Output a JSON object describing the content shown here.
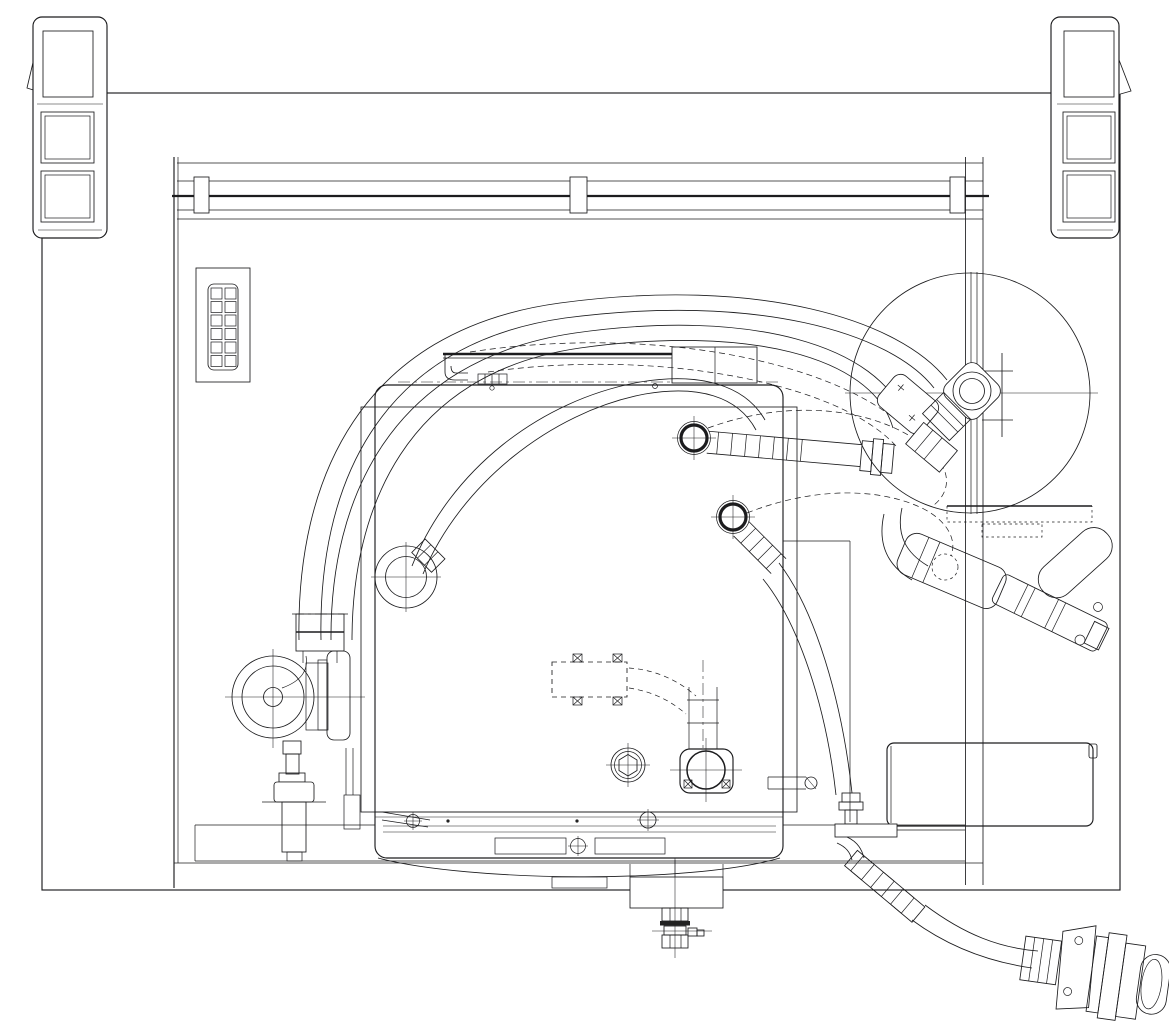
{
  "canvas": {
    "width": 1169,
    "height": 1029,
    "background": "#ffffff",
    "line_color": "#1c1c1e"
  },
  "drawing": {
    "kind": "technical CAD plan view, monochrome line drawing",
    "text_visible": false
  },
  "components": {
    "outer_frame": "outer enclosure frame",
    "vent_panel_left": "louvered vent panel with two mesh grilles, top-left corner",
    "vent_panel_right": "louvered vent panel with two mesh grilles, top-right corner",
    "top_rail": "upper slide rail with three mounting brackets",
    "control_keypad": "twelve-key control keypad panel",
    "hose_reel_circle": "large circular hose-reel outline with centre pipe and flange",
    "tank": "main rectangular tank body",
    "tank_lid": "rounded tank lid outline with top bar and junction box",
    "inlet_fitting_upper": "upper hose fitting ring on tank with ribbed hose to elbow",
    "inlet_fitting_lower": "lower hose fitting ring on tank with hose to rear valve",
    "hose_bundle": "bundle of hoses arcing over the tank",
    "left_port_fitting": "circular side port fitting on tank left wall",
    "pump_assembly": "circular pump / blower with motor and mounting foot",
    "drain_plug": "hex drain plug on tank floor",
    "outlet_flange": "square outlet flange with bolt marks and stand pipe",
    "access_box": "dashed hidden access box with corner tabs",
    "bottom_valve": "centre bottom drain valve with hex fittings",
    "service_block": "rectangular service block, lower right",
    "spray_assembly": "angled spray arm and nozzle assembly, right side",
    "mounting_plate": "flat mounting plate under hose reel",
    "discharge_hose": "ribbed discharge hose leaving rear valve",
    "discharge_connector": "large quick-connect coupler, bottom right"
  }
}
